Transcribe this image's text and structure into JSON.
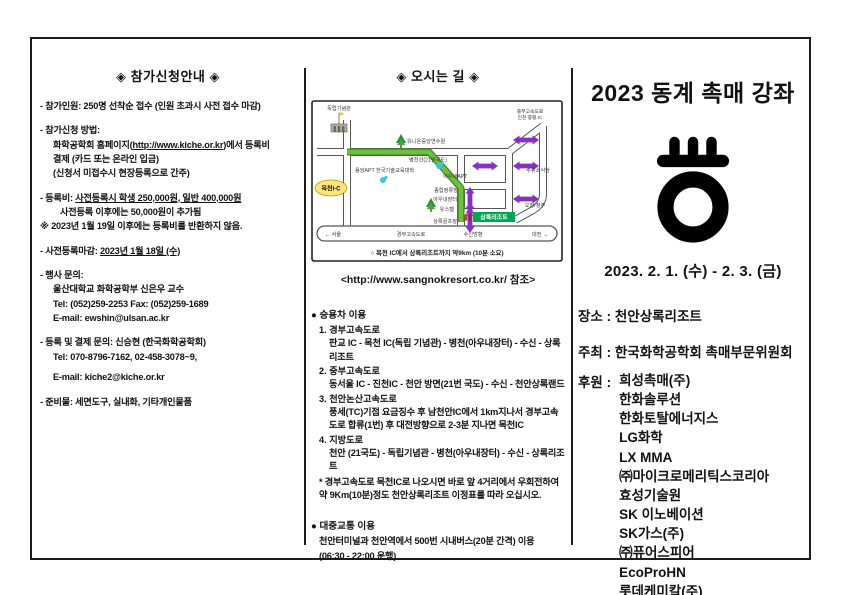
{
  "left": {
    "title": "◈ 참가신청안내 ◈",
    "attendee": "- 참가인원: 250명 선착순 접수 (인원 초과시 사전 접수 마감)",
    "apply_head": "- 참가신청 방법:",
    "apply_l1_pre": "화학공학회 홈페이지(",
    "apply_l1_url": "http://www.kiche.or.kr",
    "apply_l1_post": ")에서 등록비",
    "apply_l2": "결제 (카드 또는 온라인 입금)",
    "apply_l3": "(신청서 미접수시 현장등록으로 간주)",
    "fee_label": "- 등록비: ",
    "fee_underlined": "사전등록시 학생 250,000원, 일반 400,000원",
    "fee_l2": "사전등록 이후에는 50,000원이 추가됨",
    "fee_note": "※ 2023년 1월 19일 이후에는 등록비를 반환하지 않음.",
    "deadline_label": "- 사전등록마감: ",
    "deadline_value": "2023년 1월 18일 (수)",
    "contact1_head": "- 행사 문의:",
    "contact1_l1": "울산대학교 화학공학부 신은우 교수",
    "contact1_l2": "Tel: (052)259-2253   Fax: (052)259-1689",
    "contact1_l3": "E-mail: ewshin@ulsan.ac.kr",
    "contact2_head": "- 등록 및 결제 문의: 신승현 (한국화학공학회)",
    "contact2_l1": "Tel: 070-8796-7162, 02-458-3078~9,",
    "contact2_l2": "E-mail: kiche2@kiche.or.kr",
    "supplies": "- 준비물: 세면도구, 실내화, 기타개인물품"
  },
  "middle": {
    "title": "◈ 오시는 길 ◈",
    "map": {
      "independence_hall": "독립기념관",
      "mokcheon_ic": "목천I-C",
      "union_center": "유니온중앙연수원",
      "byeongcheon_line": "병천선(21번국도)",
      "apt_univ": "용암APT 한국기술교육대학",
      "awnae_apt": "아우내APT",
      "jonghap": "종합정류장",
      "awnae_market": "아우내장터",
      "hostel": "유스텔",
      "golf": "상록골프장",
      "resort": "상록리조트",
      "gas": "주유소식당",
      "ochang": "오창/청주",
      "jungbu1": "중부고속도로",
      "jungbu2": "진천 증평 IC",
      "seoul": "← 서울",
      "gyeongbu_exp": "경부고속도로",
      "susin": "수신방향",
      "daejeon": "대전 →",
      "caption": "○ 목천 IC에서 상록리조트까지 약9km (10분 소요)",
      "route_green": "#6fbf3f",
      "arrow_purple": "#8a2fc2",
      "ic_yellow": "#ffe57a",
      "resort_green": "#00a650"
    },
    "reference": "<http://www.sangnokresort.co.kr/ 참조>",
    "car_head": "● 승용차 이용",
    "routes": [
      {
        "head": "1. 경부고속도로",
        "body": "판교 IC - 목천 IC(독립 기념관) - 병천(아우내장터) - 수신 - 상록리조트"
      },
      {
        "head": "2. 중부고속도로",
        "body": "동서울 IC - 진천IC - 천안 방면(21번 국도) - 수신 - 천안상록랜드"
      },
      {
        "head": "3. 천안논산고속도로",
        "body": "풍세(TC)기점 요금징수 후 남천안IC에서 1km지나서 경부고속도로 합류(1번) 후 대전방향으로 2-3분 지나면 목천IC"
      },
      {
        "head": "4. 지방도로",
        "body": "천안 (21국도) - 독립기념관 - 병천(아우내장터) - 수신 - 상록리조트"
      }
    ],
    "note": "* 경부고속도로 목천IC로 나오시면 바로 앞 4거리에서 우회전하여 약 9Km(10분)정도 천안상록리조트 이정표를 따라 오십시오.",
    "transit_head": "● 대중교통 이용",
    "transit_l1": "천안터미널과 천안역에서 500번 시내버스(20분 간격) 이용",
    "transit_l2": "(06:30 - 22:00 운행)"
  },
  "right": {
    "title": "2023 동계 촉매 강좌",
    "dates": "2023. 2. 1. (수) - 2. 3. (금)",
    "venue_label": "장소 :",
    "venue": "천안상록리조트",
    "host_label": "주최 :",
    "host": "한국화학공학회 촉매부문위원회",
    "sponsor_label": "후원 :",
    "sponsors": [
      "희성촉매(주)",
      "한화솔루션",
      "한화토탈에너지스",
      "LG화학",
      "LX MMA",
      "㈜마이크로메리틱스코리아",
      "효성기술원",
      "SK 이노베이션",
      "SK가스(주)",
      "㈜퓨어스피어",
      "EcoProHN",
      "롯데케미칼(주)"
    ],
    "logo_color": "#000000"
  }
}
